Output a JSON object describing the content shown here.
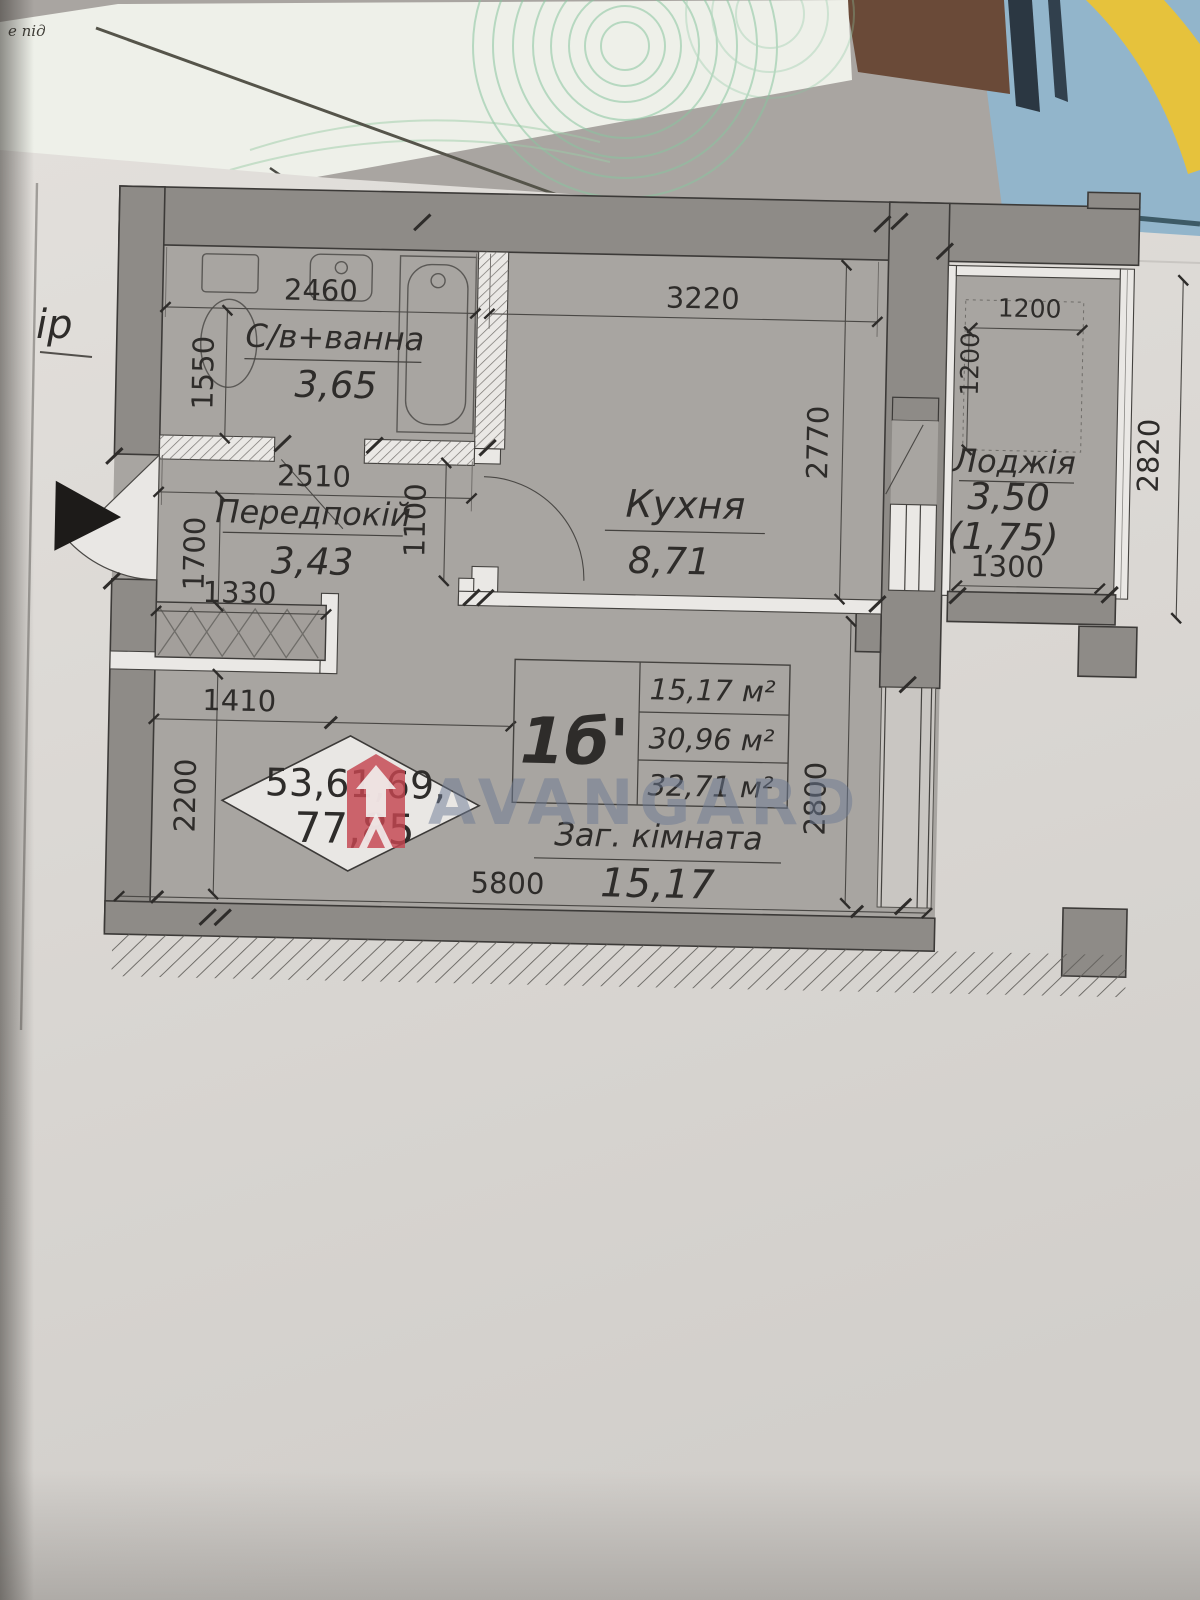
{
  "photo": {
    "background_text_fragment": "е під",
    "margin_text": "ір"
  },
  "watermark": {
    "text": "AVANGARD",
    "logo": "avangard-shield-logo",
    "text_color": "#6c7a94",
    "logo_color": "#c4464e"
  },
  "plan": {
    "unit_label": "1б'",
    "unit_areas": [
      "15,17 м²",
      "30,96 м²",
      "32,71 м²"
    ],
    "stamp_numbers": [
      "53,61,69,",
      "77,85"
    ],
    "rooms": [
      {
        "name": "С/в+ванна",
        "area": "3,65"
      },
      {
        "name": "Передпокій",
        "area": "3,43"
      },
      {
        "name": "Кухня",
        "area": "8,71"
      },
      {
        "name": "Лоджія",
        "area": "3,50",
        "area_secondary": "(1,75)"
      },
      {
        "name": "Заг. кімната",
        "area": "15,17"
      }
    ],
    "dimensions": {
      "bath_width": "2460",
      "bath_height": "1550",
      "hall_width": "2510",
      "hall_height": "1700",
      "hall_door": "1100",
      "closet_inner": "1330",
      "closet_outer": "1410",
      "living_left": "2200",
      "kitchen_width": "3220",
      "kitchen_height": "2770",
      "loggia_inner_width": "1200",
      "loggia_inner_depth": "1200",
      "loggia_width": "1300",
      "loggia_height": "2820",
      "living_width": "5800",
      "living_height": "2800"
    },
    "colors": {
      "paper": "#dcd9d5",
      "room_fill": "#a8a5a1",
      "wall_fill": "#8e8b87"
    }
  }
}
